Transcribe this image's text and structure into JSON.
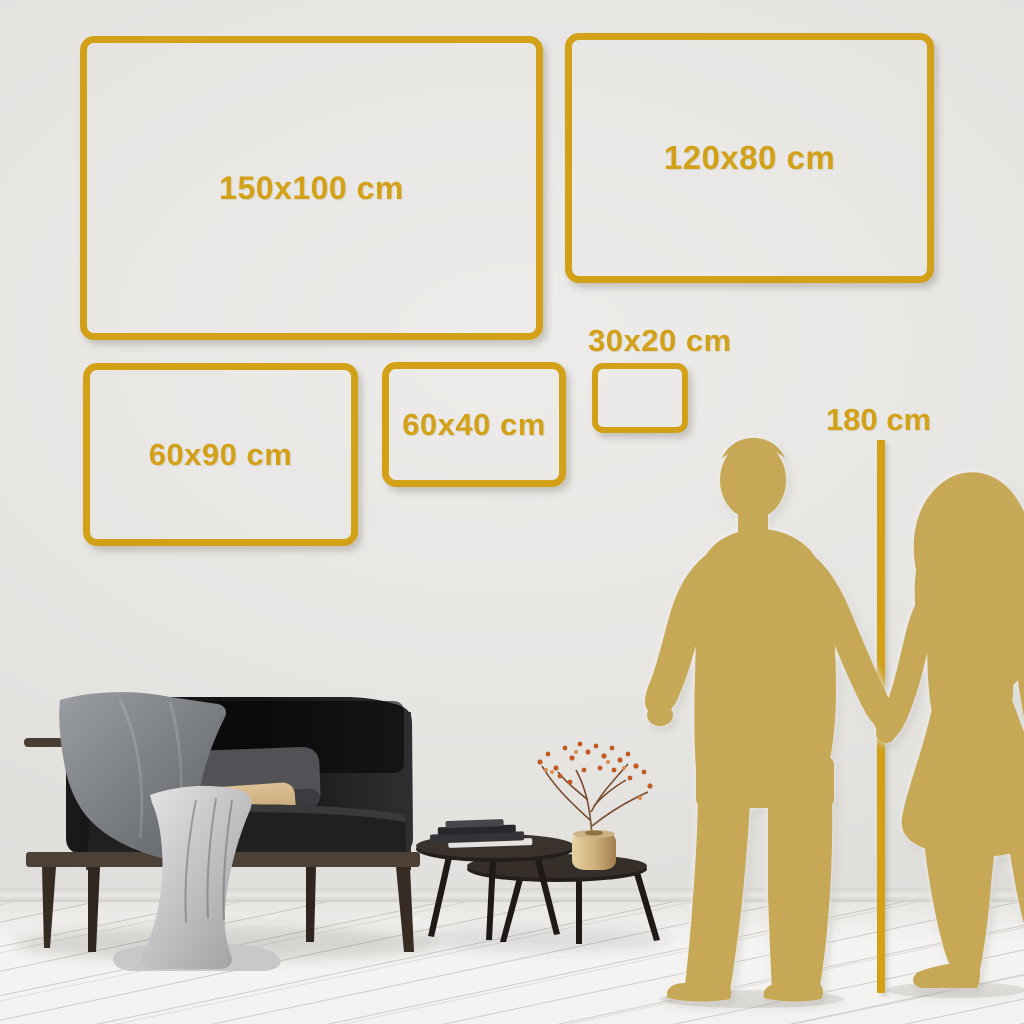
{
  "size_guide": {
    "unit": "cm",
    "frames": [
      {
        "id": "150x100",
        "label": "150x100 cm"
      },
      {
        "id": "120x80",
        "label": "120x80 cm"
      },
      {
        "id": "60x90",
        "label": "60x90 cm"
      },
      {
        "id": "60x40",
        "label": "60x40 cm"
      },
      {
        "id": "30x20",
        "label": "30x20 cm"
      }
    ],
    "height_reference": {
      "label": "180 cm"
    }
  },
  "colors": {
    "accent_gold": "#D2A117",
    "silhouette_gold": "#C7A856",
    "wall_gray": "#E5E3E0",
    "floor_white": "#F4F3F1",
    "sofa_charcoal": "#1B1B1C",
    "pillow_tan": "#D8B888"
  },
  "scene_items": [
    "sofa",
    "throw-blanket",
    "back-pillow",
    "tan-pillow",
    "draped-cloth",
    "nesting-coffee-tables",
    "book-stack",
    "brass-vase-with-branch",
    "man-silhouette",
    "woman-silhouette",
    "height-line"
  ]
}
